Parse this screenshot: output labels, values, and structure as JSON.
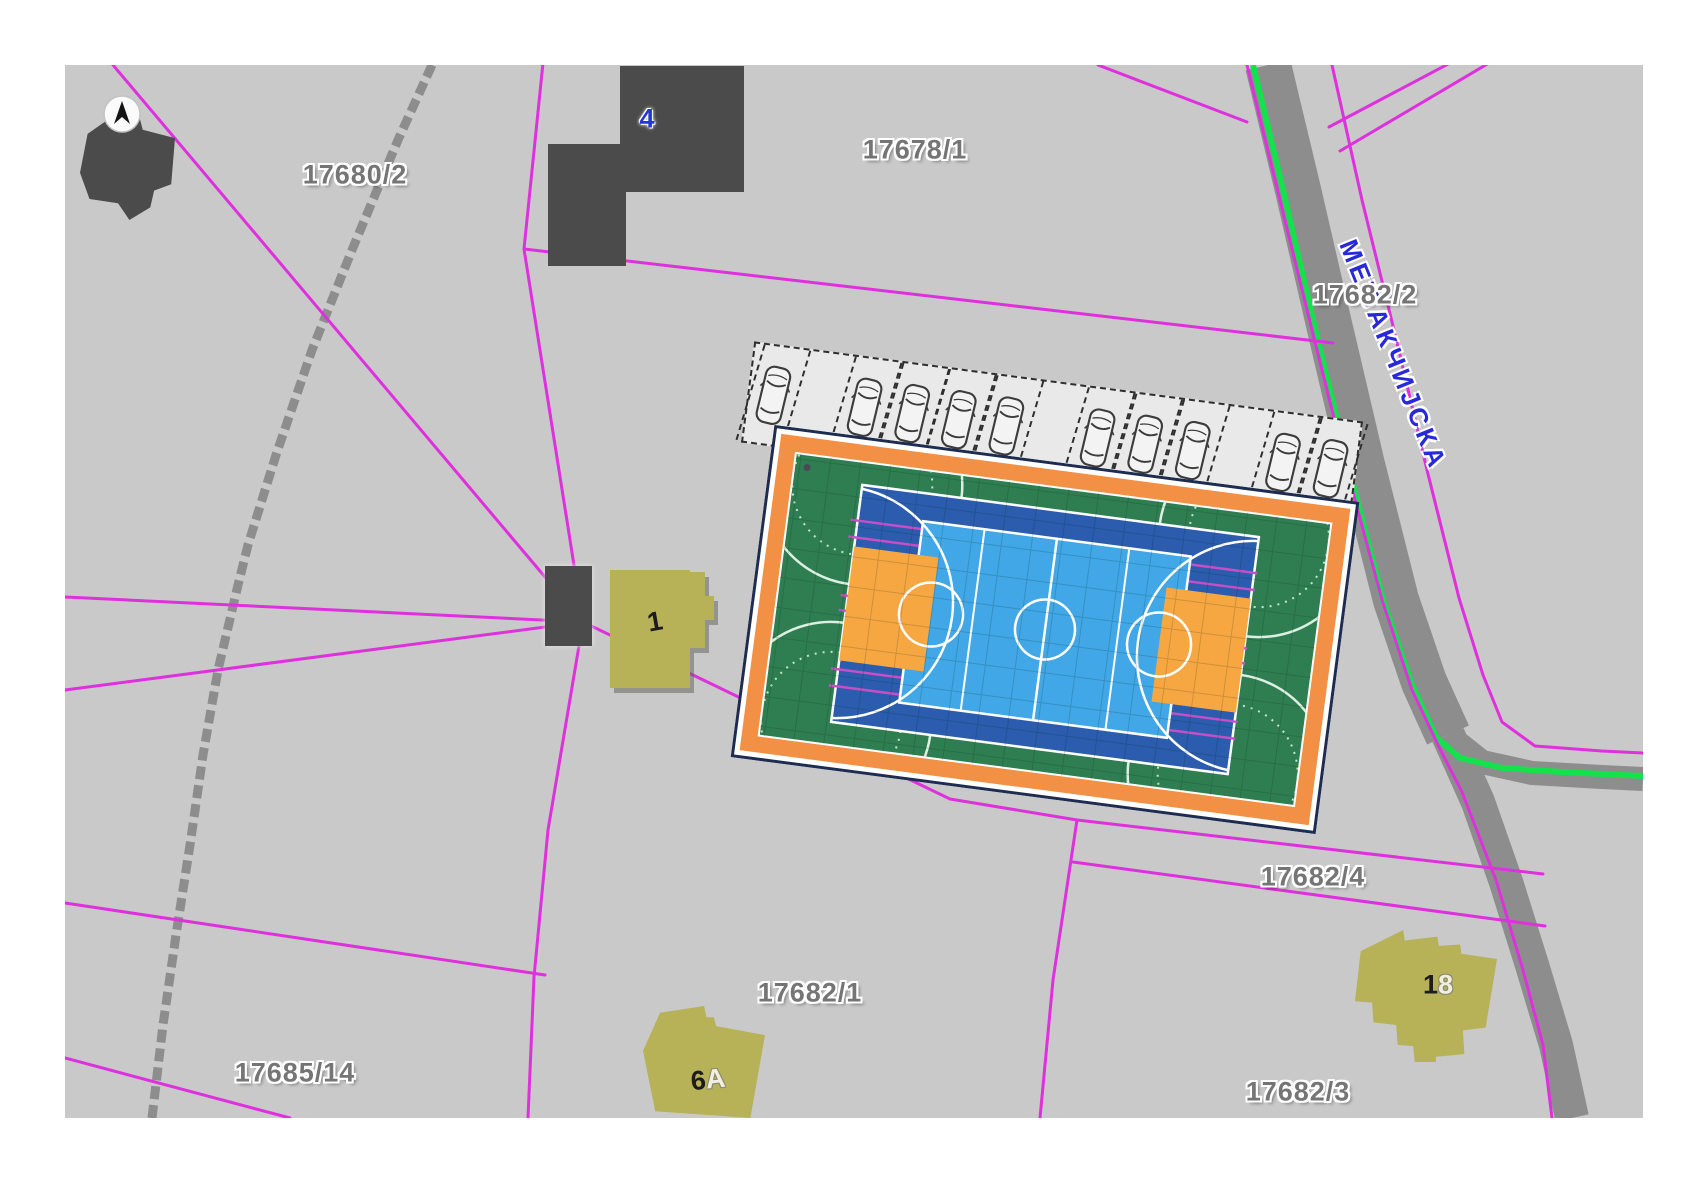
{
  "colors": {
    "page_bg": "#ffffff",
    "map_bg": "#c9c9c9",
    "parcel_line": "#de30dd",
    "route_green": "#14e14c",
    "road_gray": "#8d8d8d",
    "path_gray": "#828282",
    "building_dark": "#4b4b4b",
    "building_yellow": "#b7b258",
    "label_gray": "#757575",
    "street_blue": "#2929dc",
    "house_number_blue": "#2436d6",
    "house_number_dark": "#1c1c1c",
    "house_number_light": "#f2f0dc",
    "court_outline_navy": "#1d2c50",
    "court_orange": "#f29045",
    "court_green": "#2f7e52",
    "court_blue": "#2b5cad",
    "court_blue_light": "#41a7e6",
    "court_key_orange": "#f7a742",
    "court_magenta": "#c44fc6",
    "parking_bg": "#e9e9e9",
    "stall_line": "#2e2e2e",
    "car_line": "#3c3c3c"
  },
  "parcels": [
    {
      "id": "17680/2"
    },
    {
      "id": "17678/1"
    },
    {
      "id": "17682/2"
    },
    {
      "id": "17682/4"
    },
    {
      "id": "17682/1"
    },
    {
      "id": "17685/14"
    },
    {
      "id": "17682/3"
    }
  ],
  "street": {
    "name": "МЕЂАКЧИЈСКА"
  },
  "houses": {
    "top": "4",
    "mid": "1",
    "bottom_left_main": "6",
    "bottom_left_suffix": "A",
    "bottom_right_first": "1",
    "bottom_right_second": "8"
  },
  "parking": {
    "stall_count": 13,
    "car_count": 11,
    "occupied": [
      true,
      false,
      true,
      true,
      true,
      true,
      false,
      true,
      true,
      true,
      false,
      true,
      true
    ]
  },
  "court": {
    "kind": "multi-sport court",
    "layers": [
      "green field",
      "basketball court",
      "futsal field",
      "volleyball lines"
    ]
  }
}
